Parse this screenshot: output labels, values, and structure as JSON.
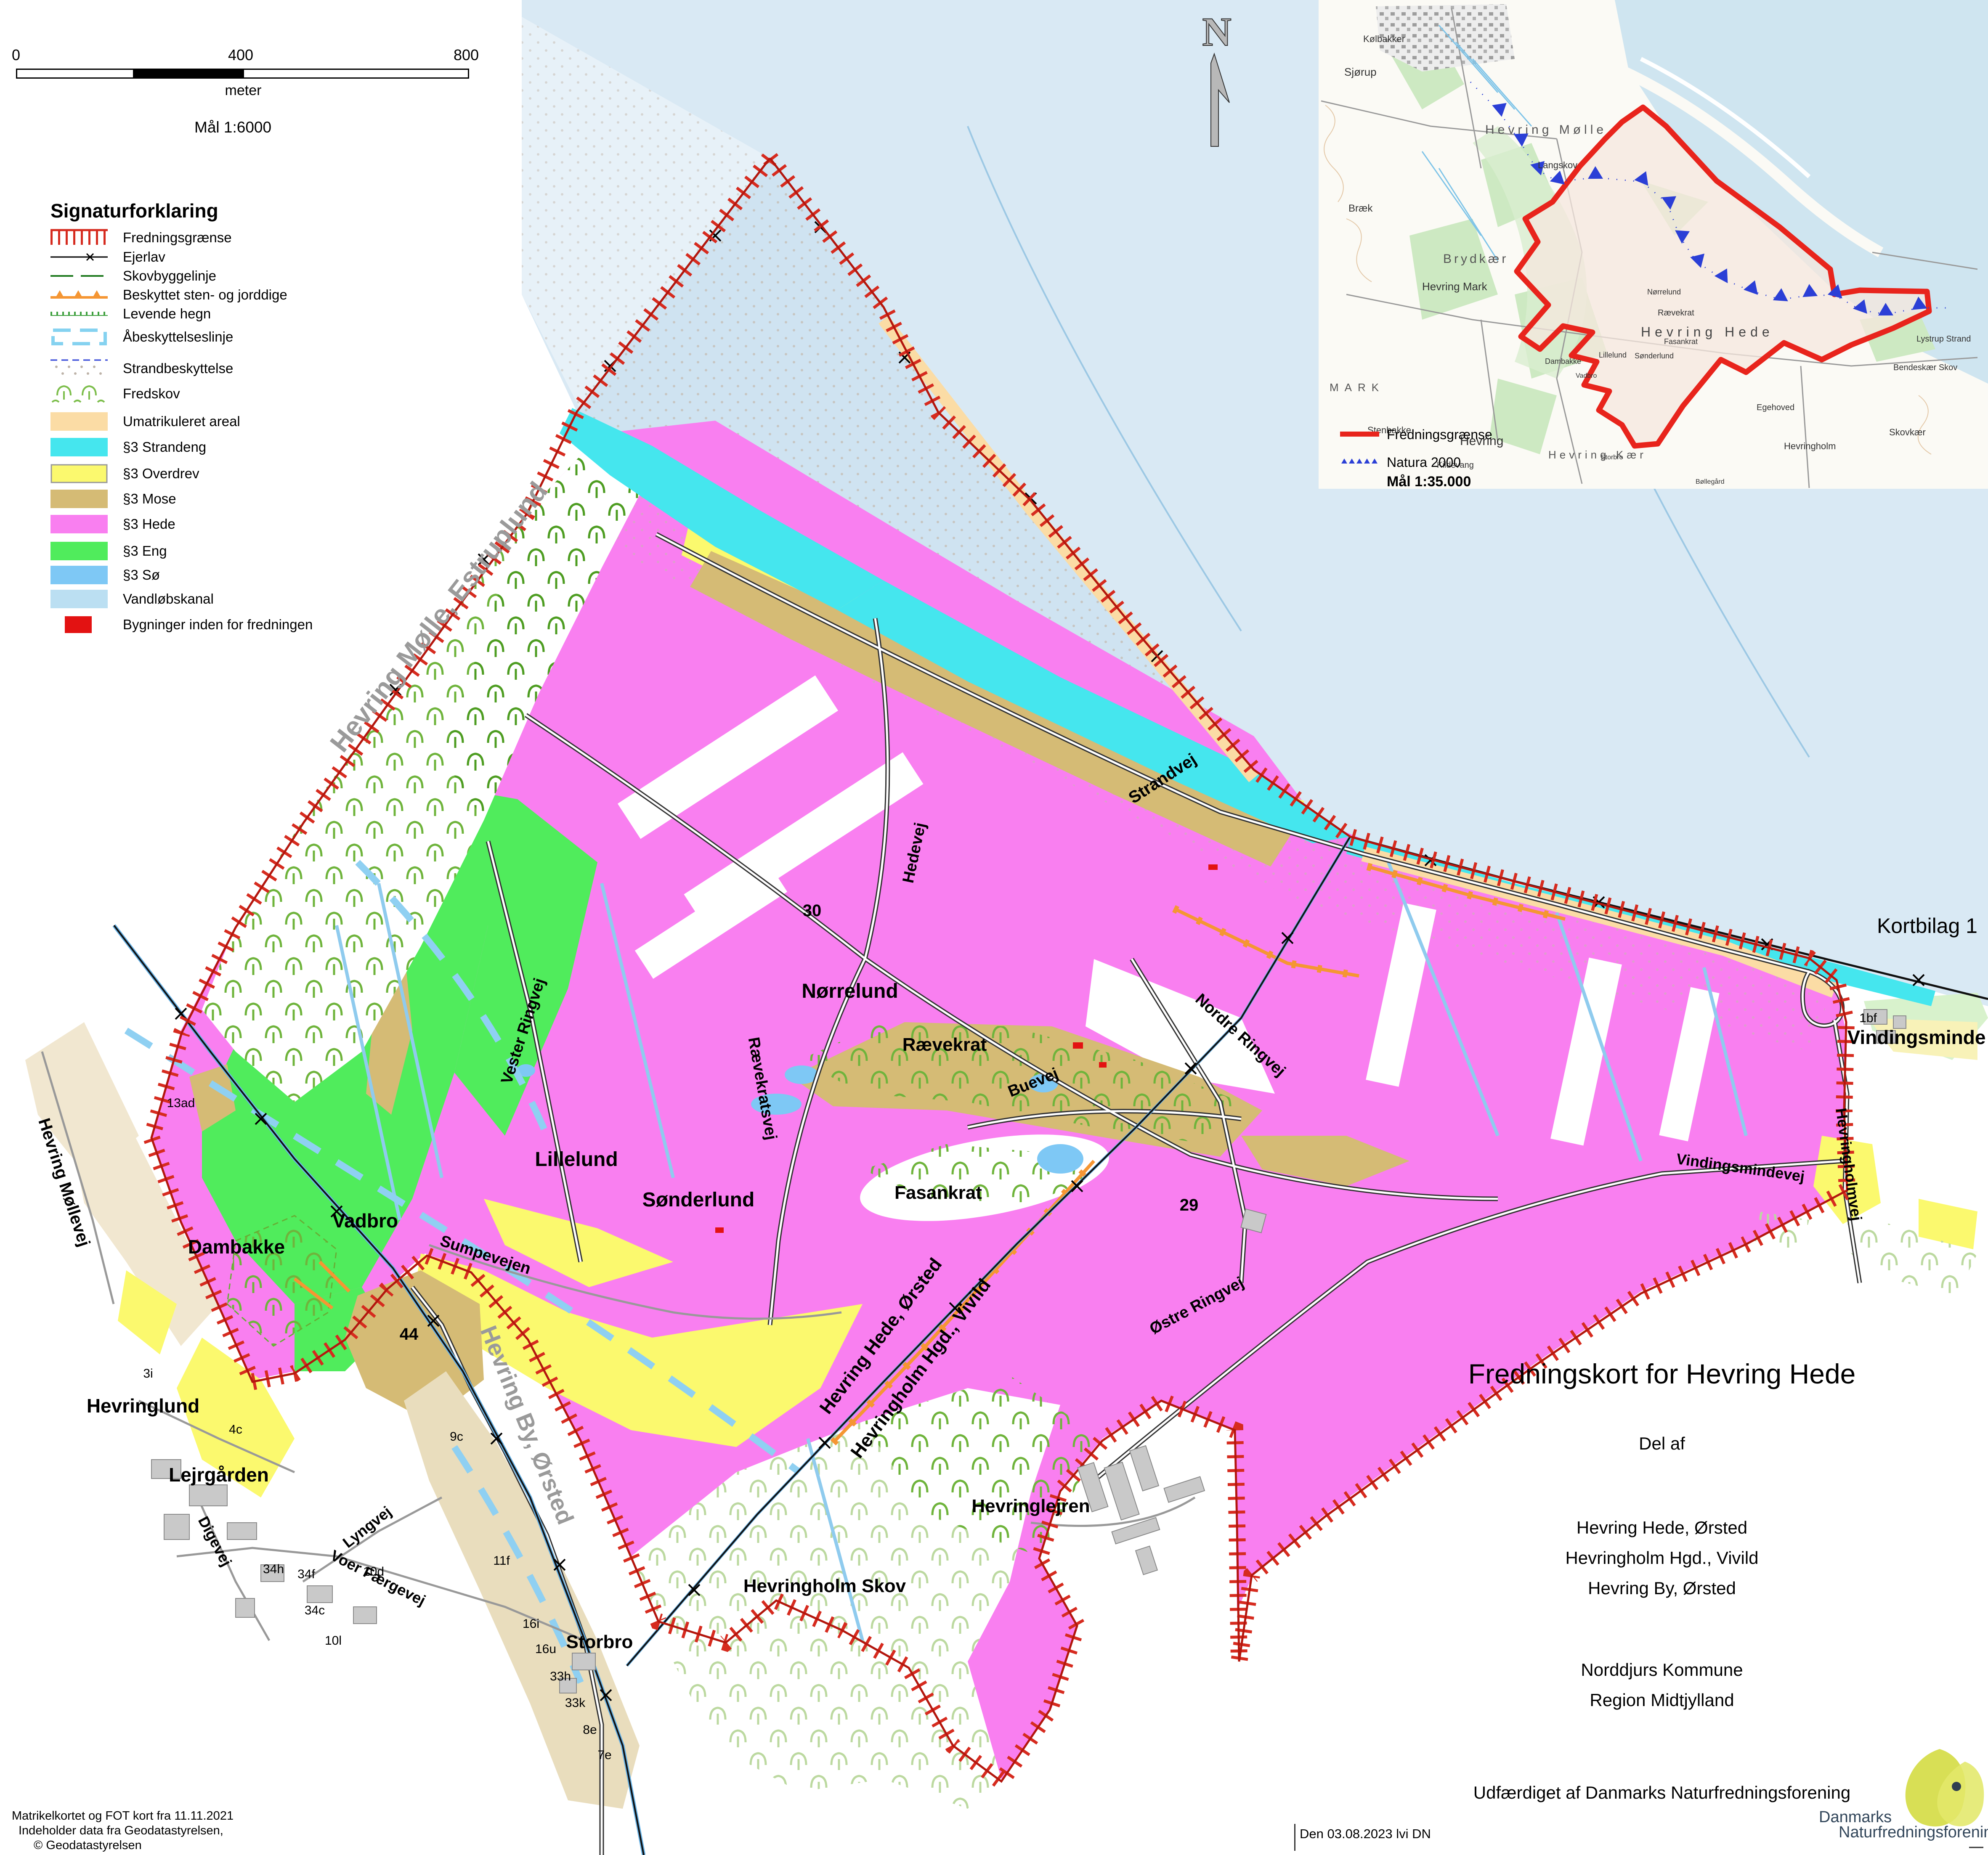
{
  "page_title": "Fredningskort for Hevring Hede",
  "kortbilag": "Kortbilag 1",
  "north_label": "N",
  "scalebar": {
    "tick_0": "0",
    "tick_400": "400",
    "tick_800": "800",
    "unit_label": "meter",
    "scale_text": "Mål 1:6000"
  },
  "legend": {
    "title": "Signaturforklaring",
    "items": [
      {
        "label": "Fredningsgrænse",
        "type": "line-red-hatch",
        "color": "#D62B1F"
      },
      {
        "label": "Ejerlav",
        "type": "line-black-cross",
        "color": "#000000"
      },
      {
        "label": "Skovbyggelinje",
        "type": "line-green-dash",
        "color": "#1F7A1F"
      },
      {
        "label": "Beskyttet sten- og jorddige",
        "type": "line-orange-bump",
        "color": "#F59633"
      },
      {
        "label": "Levende hegn",
        "type": "line-green-hegn",
        "color": "#3FA03F"
      },
      {
        "label": "Åbeskyttelseslinje",
        "type": "line-lightblue-bracket",
        "color": "#85D2F0"
      },
      {
        "label": "Strandbeskyttelse",
        "type": "area-dots-navy-dash",
        "color": "#2B3FD6"
      },
      {
        "label": "Fredskov",
        "type": "area-trees",
        "color": "#7DBE4C"
      },
      {
        "label": "Umatrikuleret areal",
        "type": "area",
        "color": "#FBDCA5"
      },
      {
        "label": "§3 Strandeng",
        "type": "area",
        "color": "#45E6EE"
      },
      {
        "label": "§3 Overdrev",
        "type": "area",
        "color": "#FBF96E"
      },
      {
        "label": "§3 Mose",
        "type": "area",
        "color": "#D5BB75"
      },
      {
        "label": "§3 Hede",
        "type": "area",
        "color": "#F97FF0"
      },
      {
        "label": "§3 Eng",
        "type": "area",
        "color": "#50EC5C"
      },
      {
        "label": "§3 Sø",
        "type": "area",
        "color": "#7EC8F5"
      },
      {
        "label": "Vandløbskanal",
        "type": "area",
        "color": "#BBDFF2"
      },
      {
        "label": "Bygninger inden for fredningen",
        "type": "area-red",
        "color": "#E31212"
      }
    ]
  },
  "map_labels": {
    "hevring_molle_estruplund": "Hevring Mølle, Estruplund",
    "strandvej": "Strandvej",
    "hedevej": "Hedevej",
    "norrelund": "Nørrelund",
    "raevekrat": "Rævekrat",
    "buevej": "Buevej",
    "raevekratsvej": "Rævekratsvej",
    "vester_ringvej": "Vester Ringvej",
    "lillelund": "Lillelund",
    "sonderlund": "Sønderlund",
    "sumpevejen": "Sumpevejen",
    "vadbro": "Vadbro",
    "dambakke": "Dambakke",
    "fasankrat": "Fasankrat",
    "nordre_ringvej": "Nordre Ringvej",
    "ostre_ringvej": "Østre Ringvej",
    "hevring_hede_orsted": "Hevring Hede, Ørsted",
    "hevringholm_hgd": "Hevringholm Hgd., Vivild",
    "hevringlejren": "Hevringlejren",
    "hevringholm_skov": "Hevringholm Skov",
    "storbro": "Storbro",
    "hevringlund": "Hevringlund",
    "lejrgarden": "Lejrgården",
    "digevej": "Digevej",
    "lyngvej": "Lyngvej",
    "voer_faergevej": "Voer Færgevej",
    "hevring_by_orsted": "Hevring By, Ørsted",
    "hevring_mollevej": "Hevring Møllevej",
    "vindingsminde": "Vindingsminde",
    "vindingsmindevej": "Vindingsmindevej",
    "hevringholmvej": "Hevringholmvej"
  },
  "parcels": {
    "n30": "30",
    "n29": "29",
    "n44": "44",
    "p13ad": "13ad",
    "p3i": "3i",
    "p4c": "4c",
    "p9c": "9c",
    "p34h": "34h",
    "p34f": "34f",
    "p34c": "34c",
    "p10l": "10l",
    "p10d": "10d",
    "p11f": "11f",
    "p16i": "16i",
    "p16u": "16u",
    "p33h": "33h",
    "p33k": "33k",
    "p8e": "8e",
    "p7e": "7e",
    "p1bf": "1bf"
  },
  "inset": {
    "labels": {
      "kolbakker": "Kølbakker",
      "sjorup": "Sjørup",
      "hevring_molle": "Hevring Mølle",
      "braek": "Bræk",
      "brydkaer": "Brydkær",
      "hevring_mark": "Hevring Mark",
      "langskov": "Langskov",
      "hevring_hede": "Hevring Hede",
      "norrelund": "Nørrelund",
      "raevekrat": "Rævekrat",
      "fasankrat": "Fasankrat",
      "lillelund": "Lillelund",
      "sonderlund": "Sønderlund",
      "dambakke": "Dambakke",
      "vadbro": "Vadbro",
      "hevring": "Hevring",
      "stenbakke": "Stenbakke",
      "kildevang": "Kildevang",
      "hevring_kaer": "Hevring Kær",
      "hevringholm": "Hevringholm",
      "storbro": "Storbro",
      "bollegard": "Bøllegård",
      "lystrup_strand": "Lystrup Strand",
      "bendeskaer_skov": "Bendeskær Skov",
      "skovkaer": "Skovkær",
      "egehoved": "Egehoved",
      "mark": "MARK"
    },
    "legend": {
      "fredningsgraense": "Fredningsgrænse",
      "natura": "Natura 2000",
      "scale_text": "Mål 1:35.000"
    }
  },
  "title_block": {
    "title": "Fredningskort for Hevring Hede",
    "subtitle": "Del af",
    "areas": [
      "Hevring Hede, Ørsted",
      "Hevringholm Hgd., Vivild",
      "Hevring By, Ørsted"
    ],
    "municipality": "Norddjurs Kommune",
    "region": "Region Midtjylland",
    "issuer": "Udfærdiget af Danmarks Naturfredningsforening"
  },
  "credits": {
    "line1": "Matrikelkortet og FOT kort fra 11.11.2021",
    "line2": "Indeholder data fra Geodatastyrelsen,",
    "line3": "©   Geodatastyrelsen"
  },
  "datestamp": "Den 03.08.2023 lvi DN",
  "logo": {
    "org_line1": "Danmarks",
    "org_line2": "Naturfredningsforening"
  },
  "colors": {
    "hede_pink": "#F97FF0",
    "eng_green": "#50EC5C",
    "overdrev_yellow": "#FBF96E",
    "mose_tan": "#D5BB75",
    "strandeng_cyan": "#45E6EE",
    "so_blue": "#7EC8F5",
    "vandlob_lightblue": "#BBDFF2",
    "umatrikuleret_peach": "#FBDCA5",
    "fredning_red": "#D62B1F",
    "sea": "#D9E9F4",
    "logo_leaf": "#D8DF55",
    "logo_text": "#33475B"
  }
}
